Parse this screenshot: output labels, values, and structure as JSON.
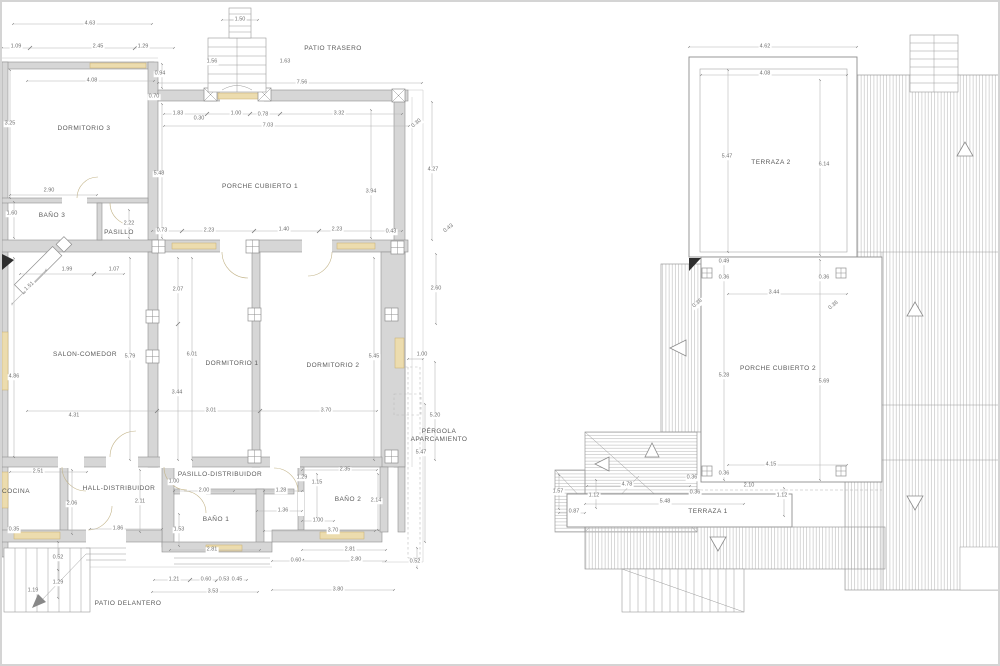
{
  "document": {
    "type": "architectural-floor-plans",
    "sheets": [
      "floor-plan",
      "roof-terrace-plan"
    ]
  },
  "colors": {
    "wall_fill": "#d6d6d6",
    "line": "#9a9a9a",
    "dimension_line": "#b3b3b3",
    "window_accent": "#ecdcae",
    "dimension_text": "#6e6e6e",
    "label_text": "#5a5a5a",
    "hatch": "#bdbdbd",
    "black_marker": "#2f2f2f"
  },
  "labels": {
    "rooms": [
      {
        "text": "DORMITORIO 3",
        "x": 82,
        "y": 127
      },
      {
        "text": "PATIO TRASERO",
        "x": 331,
        "y": 47
      },
      {
        "text": "PORCHE CUBIERTO 1",
        "x": 258,
        "y": 185
      },
      {
        "text": "BAÑO 3",
        "x": 50,
        "y": 214
      },
      {
        "text": "PASILLO",
        "x": 117,
        "y": 231
      },
      {
        "text": "SALON-COMEDOR",
        "x": 83,
        "y": 353
      },
      {
        "text": "DORMITORIO 1",
        "x": 230,
        "y": 362
      },
      {
        "text": "DORMITORIO 2",
        "x": 331,
        "y": 364
      },
      {
        "text": "PÉRGOLA\nAPARCAMIENTO",
        "x": 437,
        "y": 434
      },
      {
        "text": "COCINA",
        "x": 14,
        "y": 490
      },
      {
        "text": "HALL-DISTRIBUIDOR",
        "x": 117,
        "y": 487
      },
      {
        "text": "PASILLO-DISTRIBUIDOR",
        "x": 218,
        "y": 473
      },
      {
        "text": "BAÑO 1",
        "x": 214,
        "y": 518
      },
      {
        "text": "BAÑO 2",
        "x": 346,
        "y": 498
      },
      {
        "text": "PATIO DELANTERO",
        "x": 126,
        "y": 602
      },
      {
        "text": "TERRAZA 2",
        "x": 769,
        "y": 161
      },
      {
        "text": "PORCHE CUBIERTO 2",
        "x": 776,
        "y": 367
      },
      {
        "text": "TERRAZA 1",
        "x": 706,
        "y": 510
      }
    ],
    "dimensions": [
      {
        "text": "1.50",
        "x": 238,
        "y": 18
      },
      {
        "text": "4.63",
        "x": 88,
        "y": 22
      },
      {
        "text": "1.09",
        "x": 14,
        "y": 45
      },
      {
        "text": "2.45",
        "x": 96,
        "y": 45
      },
      {
        "text": "1.29",
        "x": 141,
        "y": 45
      },
      {
        "text": "1.56",
        "x": 210,
        "y": 60
      },
      {
        "text": "1.63",
        "x": 283,
        "y": 60
      },
      {
        "text": "0.94",
        "x": 158,
        "y": 72
      },
      {
        "text": "4.08",
        "x": 90,
        "y": 79
      },
      {
        "text": "7.56",
        "x": 300,
        "y": 81
      },
      {
        "text": "0.70",
        "x": 152,
        "y": 95
      },
      {
        "text": "1.83",
        "x": 176,
        "y": 112
      },
      {
        "text": "0.30",
        "x": 197,
        "y": 117
      },
      {
        "text": "1.00",
        "x": 234,
        "y": 112
      },
      {
        "text": "0.78",
        "x": 261,
        "y": 113
      },
      {
        "text": "3.32",
        "x": 337,
        "y": 112
      },
      {
        "text": "7.03",
        "x": 266,
        "y": 124
      },
      {
        "text": "0.30",
        "x": 415,
        "y": 122,
        "rot": 40
      },
      {
        "text": "3.25",
        "x": 8,
        "y": 122
      },
      {
        "text": "4.27",
        "x": 431,
        "y": 168
      },
      {
        "text": "5.48",
        "x": 157,
        "y": 172
      },
      {
        "text": "3.94",
        "x": 369,
        "y": 190
      },
      {
        "text": "2.90",
        "x": 47,
        "y": 189
      },
      {
        "text": "1.60",
        "x": 10,
        "y": 212
      },
      {
        "text": "2.22",
        "x": 127,
        "y": 222
      },
      {
        "text": "0.73",
        "x": 160,
        "y": 229
      },
      {
        "text": "2.23",
        "x": 207,
        "y": 229
      },
      {
        "text": "1.40",
        "x": 282,
        "y": 228
      },
      {
        "text": "2.23",
        "x": 335,
        "y": 228
      },
      {
        "text": "0.43",
        "x": 389,
        "y": 230
      },
      {
        "text": "0.43",
        "x": 447,
        "y": 227,
        "rot": 38
      },
      {
        "text": "1.99",
        "x": 65,
        "y": 268
      },
      {
        "text": "1.07",
        "x": 112,
        "y": 268
      },
      {
        "text": "1.51",
        "x": 28,
        "y": 285,
        "rot": 42
      },
      {
        "text": "2.07",
        "x": 176,
        "y": 288
      },
      {
        "text": "2.60",
        "x": 434,
        "y": 287
      },
      {
        "text": "6.01",
        "x": 190,
        "y": 353
      },
      {
        "text": "5.79",
        "x": 128,
        "y": 355
      },
      {
        "text": "5.45",
        "x": 372,
        "y": 355
      },
      {
        "text": "3.44",
        "x": 175,
        "y": 391
      },
      {
        "text": "4.86",
        "x": 12,
        "y": 375
      },
      {
        "text": "1.00",
        "x": 420,
        "y": 353
      },
      {
        "text": "4.31",
        "x": 72,
        "y": 414
      },
      {
        "text": "3.01",
        "x": 209,
        "y": 409
      },
      {
        "text": "3.70",
        "x": 324,
        "y": 409
      },
      {
        "text": "5.20",
        "x": 433,
        "y": 414
      },
      {
        "text": "5.47",
        "x": 419,
        "y": 451
      },
      {
        "text": "2.51",
        "x": 36,
        "y": 470
      },
      {
        "text": "2.35",
        "x": 343,
        "y": 468
      },
      {
        "text": "1.00",
        "x": 172,
        "y": 480
      },
      {
        "text": "1.29",
        "x": 300,
        "y": 476
      },
      {
        "text": "1.15",
        "x": 315,
        "y": 481
      },
      {
        "text": "2.00",
        "x": 202,
        "y": 489
      },
      {
        "text": "1.28",
        "x": 279,
        "y": 489
      },
      {
        "text": "2.06",
        "x": 70,
        "y": 502
      },
      {
        "text": "2.11",
        "x": 138,
        "y": 500
      },
      {
        "text": "2.14",
        "x": 374,
        "y": 499
      },
      {
        "text": "1.36",
        "x": 281,
        "y": 509
      },
      {
        "text": "1.00",
        "x": 316,
        "y": 519
      },
      {
        "text": "1.53",
        "x": 177,
        "y": 528
      },
      {
        "text": "3.70",
        "x": 331,
        "y": 529
      },
      {
        "text": "0.35",
        "x": 12,
        "y": 528
      },
      {
        "text": "1.86",
        "x": 116,
        "y": 527
      },
      {
        "text": "2.81",
        "x": 210,
        "y": 548
      },
      {
        "text": "2.81",
        "x": 348,
        "y": 548
      },
      {
        "text": "0.52",
        "x": 56,
        "y": 556
      },
      {
        "text": "0.60",
        "x": 294,
        "y": 559
      },
      {
        "text": "2.80",
        "x": 354,
        "y": 558
      },
      {
        "text": "0.52",
        "x": 413,
        "y": 560
      },
      {
        "text": "1.21",
        "x": 172,
        "y": 578
      },
      {
        "text": "0.60",
        "x": 204,
        "y": 578
      },
      {
        "text": "0.53",
        "x": 222,
        "y": 578
      },
      {
        "text": "0.45",
        "x": 235,
        "y": 578
      },
      {
        "text": "1.29",
        "x": 56,
        "y": 581
      },
      {
        "text": "1.19",
        "x": 31,
        "y": 589
      },
      {
        "text": "3.53",
        "x": 211,
        "y": 590
      },
      {
        "text": "3.80",
        "x": 336,
        "y": 588
      },
      {
        "text": "4.62",
        "x": 763,
        "y": 45
      },
      {
        "text": "4.08",
        "x": 763,
        "y": 72
      },
      {
        "text": "5.47",
        "x": 725,
        "y": 155
      },
      {
        "text": "6.14",
        "x": 822,
        "y": 163
      },
      {
        "text": "0.49",
        "x": 722,
        "y": 260
      },
      {
        "text": "0.36",
        "x": 722,
        "y": 276
      },
      {
        "text": "0.36",
        "x": 822,
        "y": 276
      },
      {
        "text": "0.36",
        "x": 696,
        "y": 302,
        "rot": 40
      },
      {
        "text": "0.36",
        "x": 832,
        "y": 304,
        "rot": 40
      },
      {
        "text": "3.44",
        "x": 772,
        "y": 291
      },
      {
        "text": "5.28",
        "x": 722,
        "y": 374
      },
      {
        "text": "5.69",
        "x": 822,
        "y": 380
      },
      {
        "text": "4.15",
        "x": 769,
        "y": 463
      },
      {
        "text": "0.36",
        "x": 722,
        "y": 472
      },
      {
        "text": "0.36",
        "x": 690,
        "y": 476
      },
      {
        "text": "0.36",
        "x": 693,
        "y": 491
      },
      {
        "text": "4.78",
        "x": 625,
        "y": 483
      },
      {
        "text": "2.10",
        "x": 747,
        "y": 484
      },
      {
        "text": "1.12",
        "x": 780,
        "y": 494
      },
      {
        "text": "1.57",
        "x": 556,
        "y": 490
      },
      {
        "text": "1.12",
        "x": 592,
        "y": 494
      },
      {
        "text": "5.48",
        "x": 663,
        "y": 500
      },
      {
        "text": "0.87",
        "x": 572,
        "y": 510
      }
    ]
  }
}
